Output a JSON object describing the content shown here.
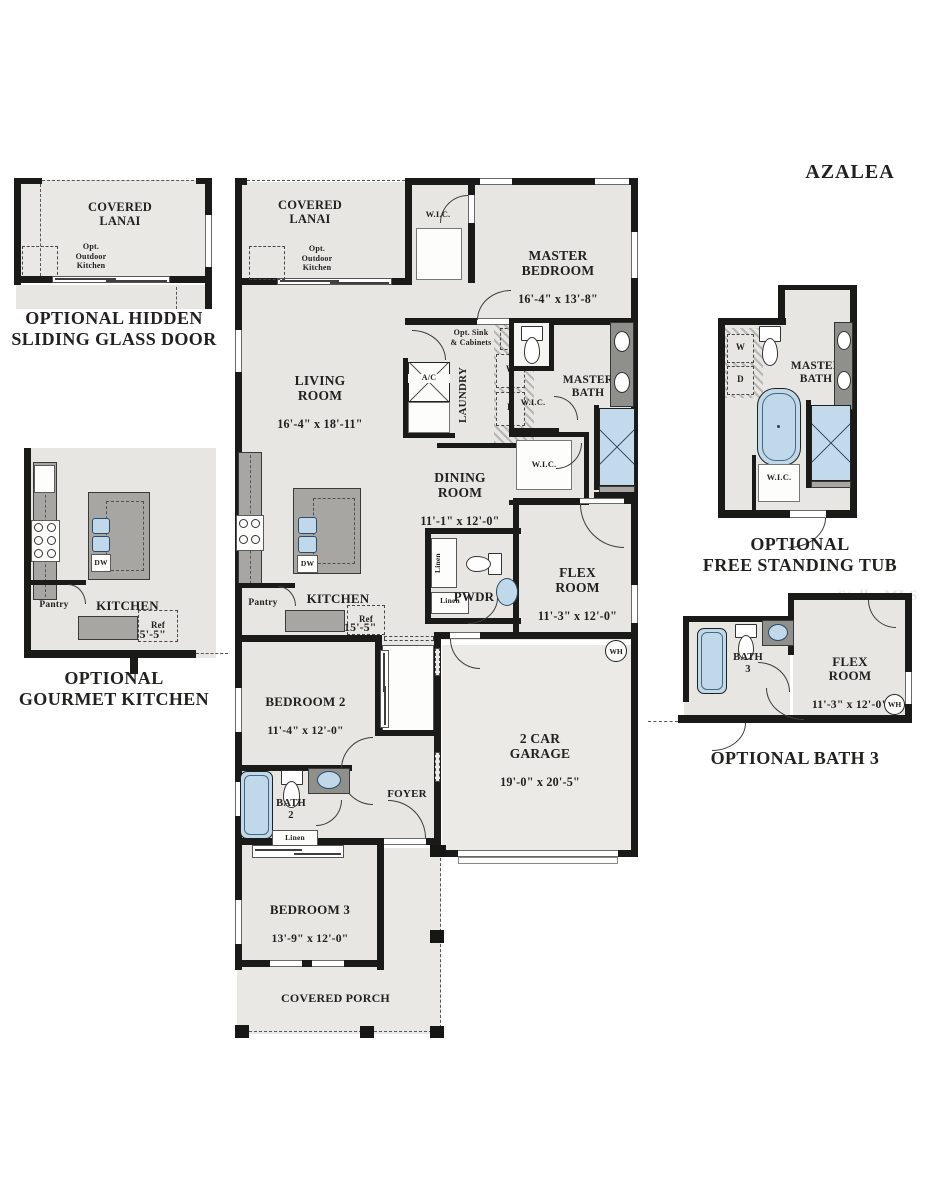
{
  "title": "AZALEA",
  "watermark": "StellarMLS",
  "captions": {
    "hidden_sliding_door": "OPTIONAL HIDDEN\nSLIDING GLASS DOOR",
    "gourmet_kitchen": "OPTIONAL\nGOURMET KITCHEN",
    "free_standing_tub": "OPTIONAL\nFREE STANDING TUB",
    "bath3": "OPTIONAL BATH 3"
  },
  "labels": {
    "covered_lanai": "COVERED\nLANAI",
    "opt_outdoor_kitchen": "Opt.\nOutdoor\nKitchen",
    "wic": "W.I.C.",
    "master_bedroom": {
      "name": "MASTER\nBEDROOM",
      "dims": "16'-4\" x 13'-8\""
    },
    "living_room": {
      "name": "LIVING\nROOM",
      "dims": "16'-4\" x 18'-11\""
    },
    "ac": "A/C",
    "laundry": "LAUNDRY",
    "opt_sink_cabinets": "Opt. Sink\n& Cabinets",
    "washer": "W",
    "dryer": "D",
    "master_bath": "MASTER\nBATH",
    "dining_room": {
      "name": "DINING\nROOM",
      "dims": "11'-1\" x 12'-0\""
    },
    "kitchen": {
      "name": "KITCHEN",
      "dims": "14'-0\" x 15'-5\""
    },
    "dw": "DW",
    "pantry": "Pantry",
    "ref": "Ref",
    "linen": "Linen",
    "pwdr": "PWDR",
    "flex_room": {
      "name": "FLEX\nROOM",
      "dims": "11'-3\" x 12'-0\""
    },
    "bedroom2": {
      "name": "BEDROOM 2",
      "dims": "11'-4\" x 12'-0\""
    },
    "bath2": "BATH\n2",
    "foyer": "FOYER",
    "garage": {
      "name": "2 CAR\nGARAGE",
      "dims": "19'-0\" x 20'-5\""
    },
    "bedroom3": {
      "name": "BEDROOM 3",
      "dims": "13'-9\" x 12'-0\""
    },
    "covered_porch": "COVERED PORCH",
    "wh": "WH",
    "bath3": "BATH\n3"
  },
  "colors": {
    "wall": "#1a1a18",
    "room_fill": "#e7e6e3",
    "porch_fill": "#e9e8e5",
    "counter": "#a7a6a3",
    "vanity": "#8f8f8c",
    "fixture_blue": "#bfd8ea",
    "text": "#22211f"
  }
}
